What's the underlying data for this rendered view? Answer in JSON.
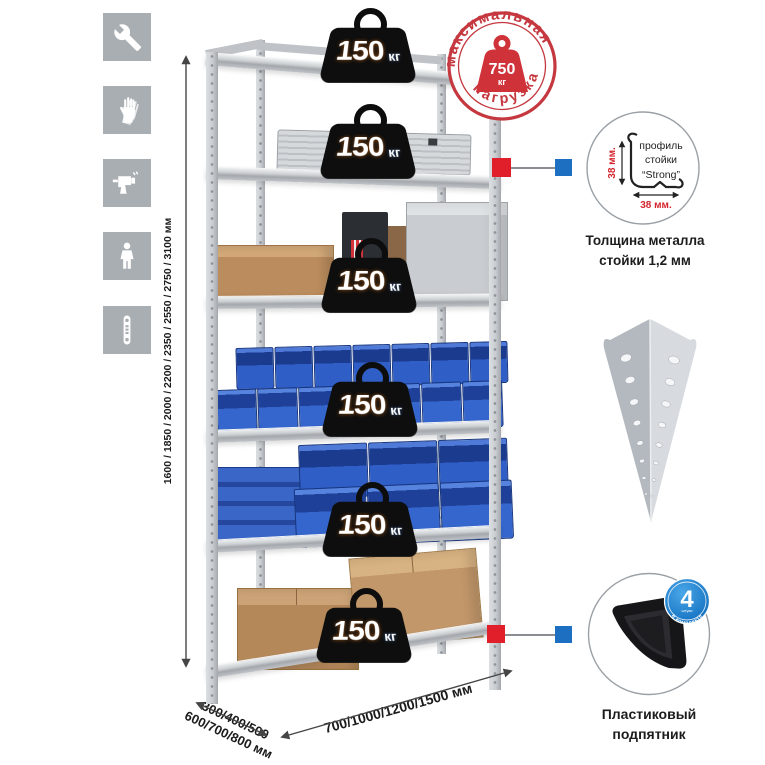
{
  "colors": {
    "accent_red": "#cf3238",
    "connector_red": "#e01f2b",
    "connector_blue": "#1d6fc2",
    "badge_blue": "#1779c6",
    "bin_blue": "#2f5ec6",
    "metal_gray": "#c9cdd1",
    "icon_gray": "#a9aeb3",
    "cardboard": "#b9895a"
  },
  "sidebar_icons": [
    {
      "name": "wrench-icon"
    },
    {
      "name": "gloves-icon"
    },
    {
      "name": "drill-icon"
    },
    {
      "name": "person-icon"
    },
    {
      "name": "level-icon"
    }
  ],
  "dimensions": {
    "height_label": "1600 / 1850 / 2000 / 2200 / 2350 / 2550 / 2750 / 3100 мм",
    "depth_label_line1": "300/400/500",
    "depth_label_line2": "600/700/800 мм",
    "width_label": "700/1000/1200/1500 мм"
  },
  "max_load_stamp": {
    "arc_top": "максимальная",
    "arc_bottom": "нагрузка",
    "value": "750",
    "unit": "кг"
  },
  "shelf_load_badges": [
    {
      "value": "150",
      "unit": "кг"
    },
    {
      "value": "150",
      "unit": "кг"
    },
    {
      "value": "150",
      "unit": "кг"
    },
    {
      "value": "150",
      "unit": "кг"
    },
    {
      "value": "150",
      "unit": "кг"
    },
    {
      "value": "150",
      "unit": "кг"
    }
  ],
  "profile_detail": {
    "label_line1": "профиль",
    "label_line2": "стойки",
    "label_line3": "“Strong”",
    "vertical_dim": "38 мм.",
    "horizontal_dim": "38 мм.",
    "caption_line1": "Толщина металла",
    "caption_line2": "стойки 1,2 мм"
  },
  "foot_detail": {
    "badge_value": "4",
    "badge_unit": "штуки",
    "badge_arc": "в комплекте",
    "caption_line1": "Пластиковый",
    "caption_line2": "подпятник"
  }
}
